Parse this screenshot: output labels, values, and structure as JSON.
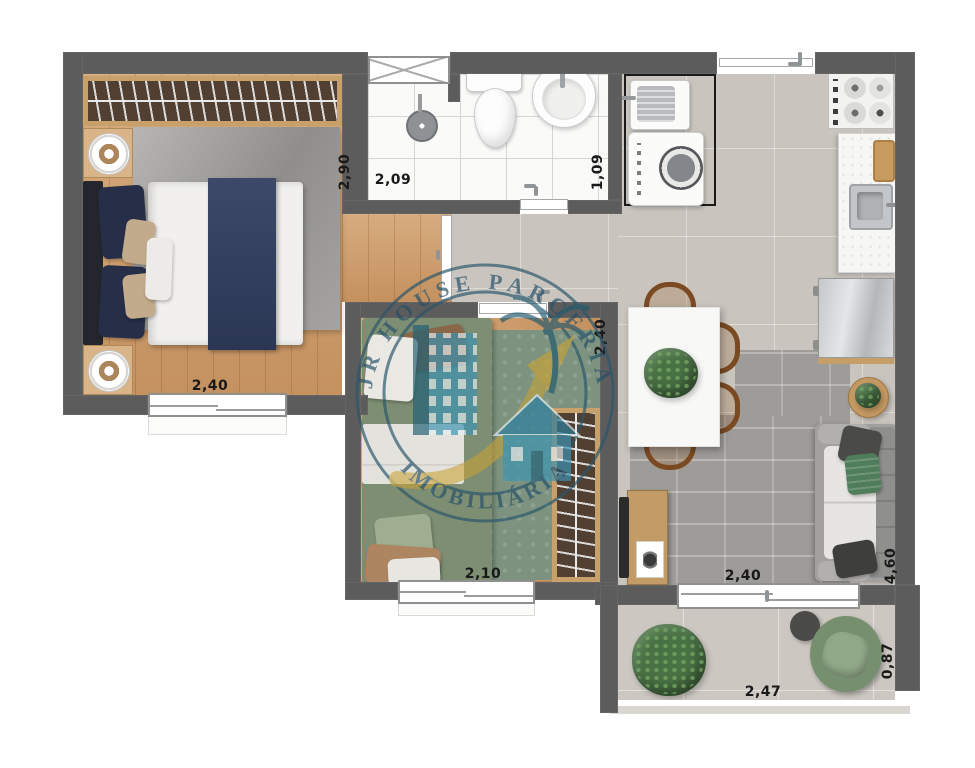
{
  "plan": {
    "watermark": {
      "arc_top": "JR HOUSE PARCERIA",
      "arc_bottom": "IMOBILIÁRIA"
    },
    "rooms": {
      "bedroom1": {
        "width": "2,40",
        "depth": "2,90"
      },
      "bathroom": {
        "width": "2,09",
        "depth": "1,09"
      },
      "bedroom2": {
        "width": "2,10",
        "depth": "2,40"
      },
      "living": {
        "width": "2,40",
        "depth": "4,60"
      },
      "balcony": {
        "width": "2,47",
        "depth": "0,87"
      }
    },
    "colors": {
      "wall": "#5d5c5c",
      "wood_floor": "#cfa276",
      "tile_floor": "#c9c4be",
      "bath_tile": "#fafaf9",
      "rug_gray": "#9e9c99",
      "rug_green": "#7d937f",
      "bed_navy": "#32405f",
      "bed_green": "#7e8e73",
      "sofa_pillow_green": "#4f7c59",
      "watermark_teal": "#29566b",
      "watermark_gold": "#c9a235"
    }
  }
}
